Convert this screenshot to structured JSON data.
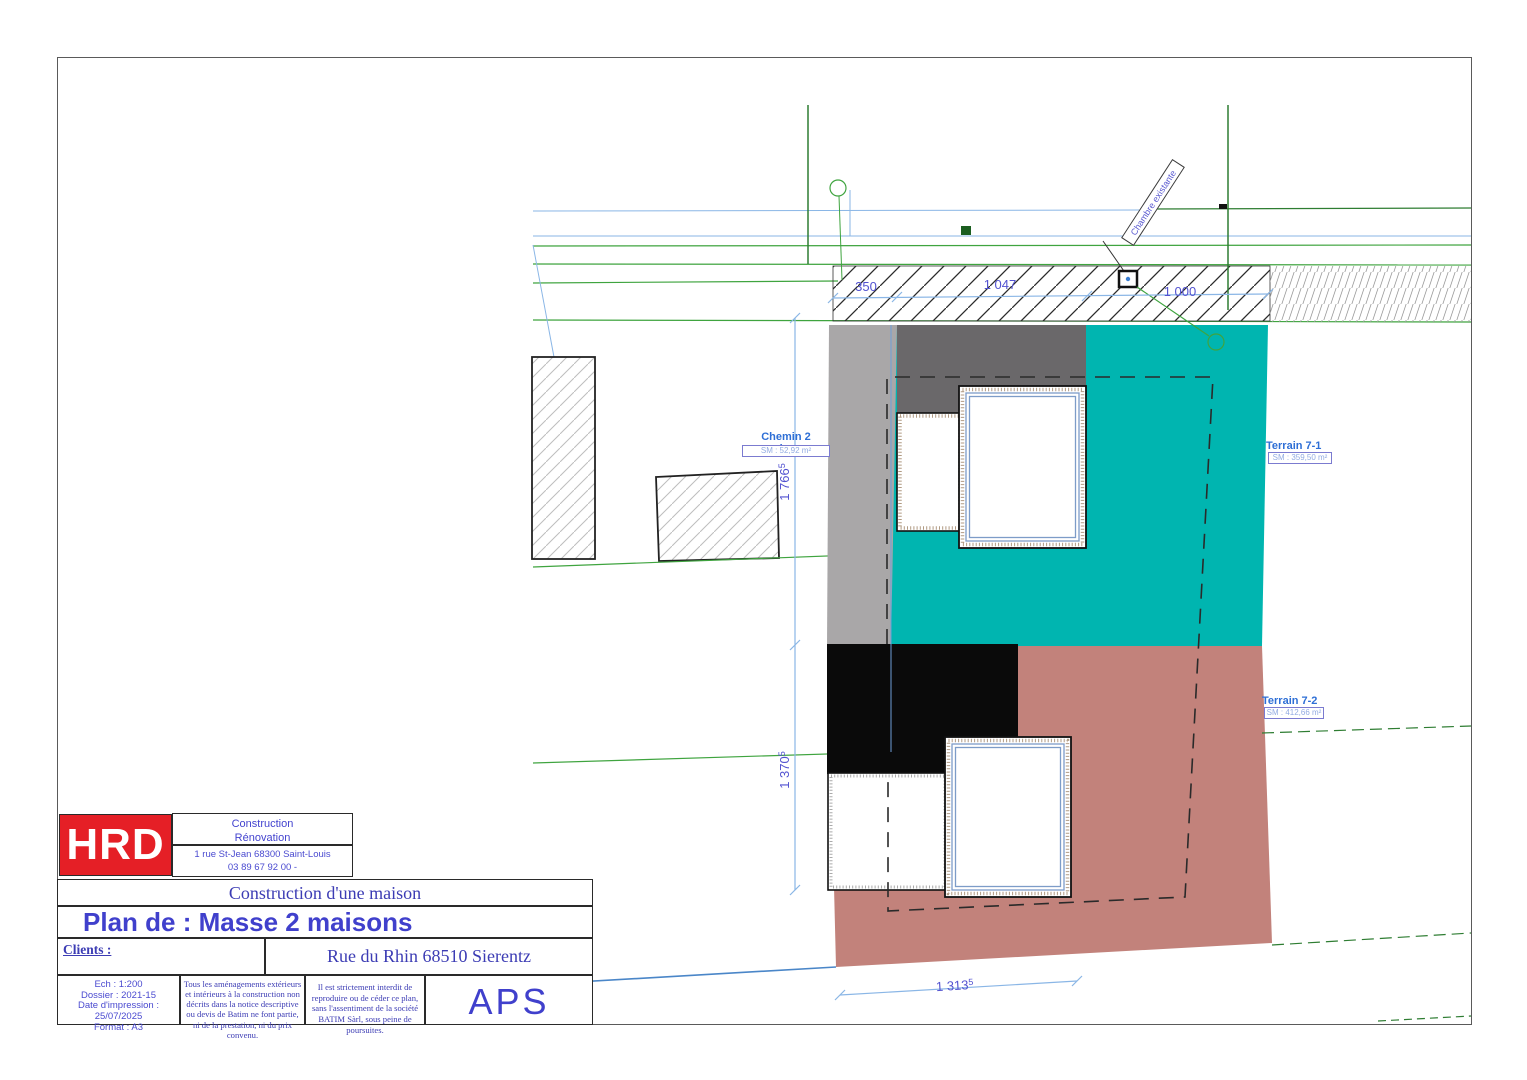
{
  "title_block": {
    "logo": "HRD",
    "company": "Construction\nRénovation",
    "address": "1 rue St-Jean 68300 Saint-Louis\n03 89 67 92 00    -",
    "project": "Construction d'une maison",
    "plan_title": "Plan de : Masse 2 maisons",
    "clients_label": "Clients :",
    "site_address": "Rue du Rhin 68510 Sierentz",
    "meta": "Ech : 1:200\nDossier : 2021-15\nDate d'impression :\n25/07/2025\nFormat : A3",
    "disclaimer_1": "Tous les aménagements extérieurs et intérieurs à la construction non décrits dans la notice descriptive ou devis de Batim ne font partie, ni de la prestation, ni du prix convenu.",
    "disclaimer_2": "Il est strictement interdit de reproduire ou de céder ce plan, sans l'assentiment de la société BATIM Sàrl, sous peine de poursuites.",
    "phase": "APS"
  },
  "plan": {
    "labels": {
      "chemin": {
        "name": "Chemin 2 maisons",
        "area": "SM : 52,92 m²"
      },
      "terrain_7_1": {
        "name": "Terrain 7-1",
        "area": "SM : 359,50 m²"
      },
      "terrain_7_2": {
        "name": "Terrain 7-2",
        "area": "SM : 412,66 m²"
      },
      "chambre": "Chambre existante"
    },
    "dimensions": {
      "d350": "350",
      "d1047": "1 047",
      "d1000": "1 000",
      "d1766": {
        "main": "1 766",
        "sup": "5"
      },
      "d1370": {
        "main": "1 370",
        "sup": "5"
      },
      "d1313": {
        "main": "1 313",
        "sup": "5"
      }
    },
    "colors": {
      "terrain_7_1_fill": "#00b5b0",
      "terrain_7_2_fill": "#c2827b",
      "chemin_fill": "#a9a7a8",
      "existing_dark_fill": "#6a686a",
      "building_black": "#0a0a0a",
      "boundary_green": "#3fa43f",
      "dimension_blue": "#8ab6e6",
      "dim_text_blue": "#5252d0",
      "label_blue": "#2e6fd6",
      "logo_red": "#e51f26",
      "title_blue": "#4040cc"
    }
  }
}
